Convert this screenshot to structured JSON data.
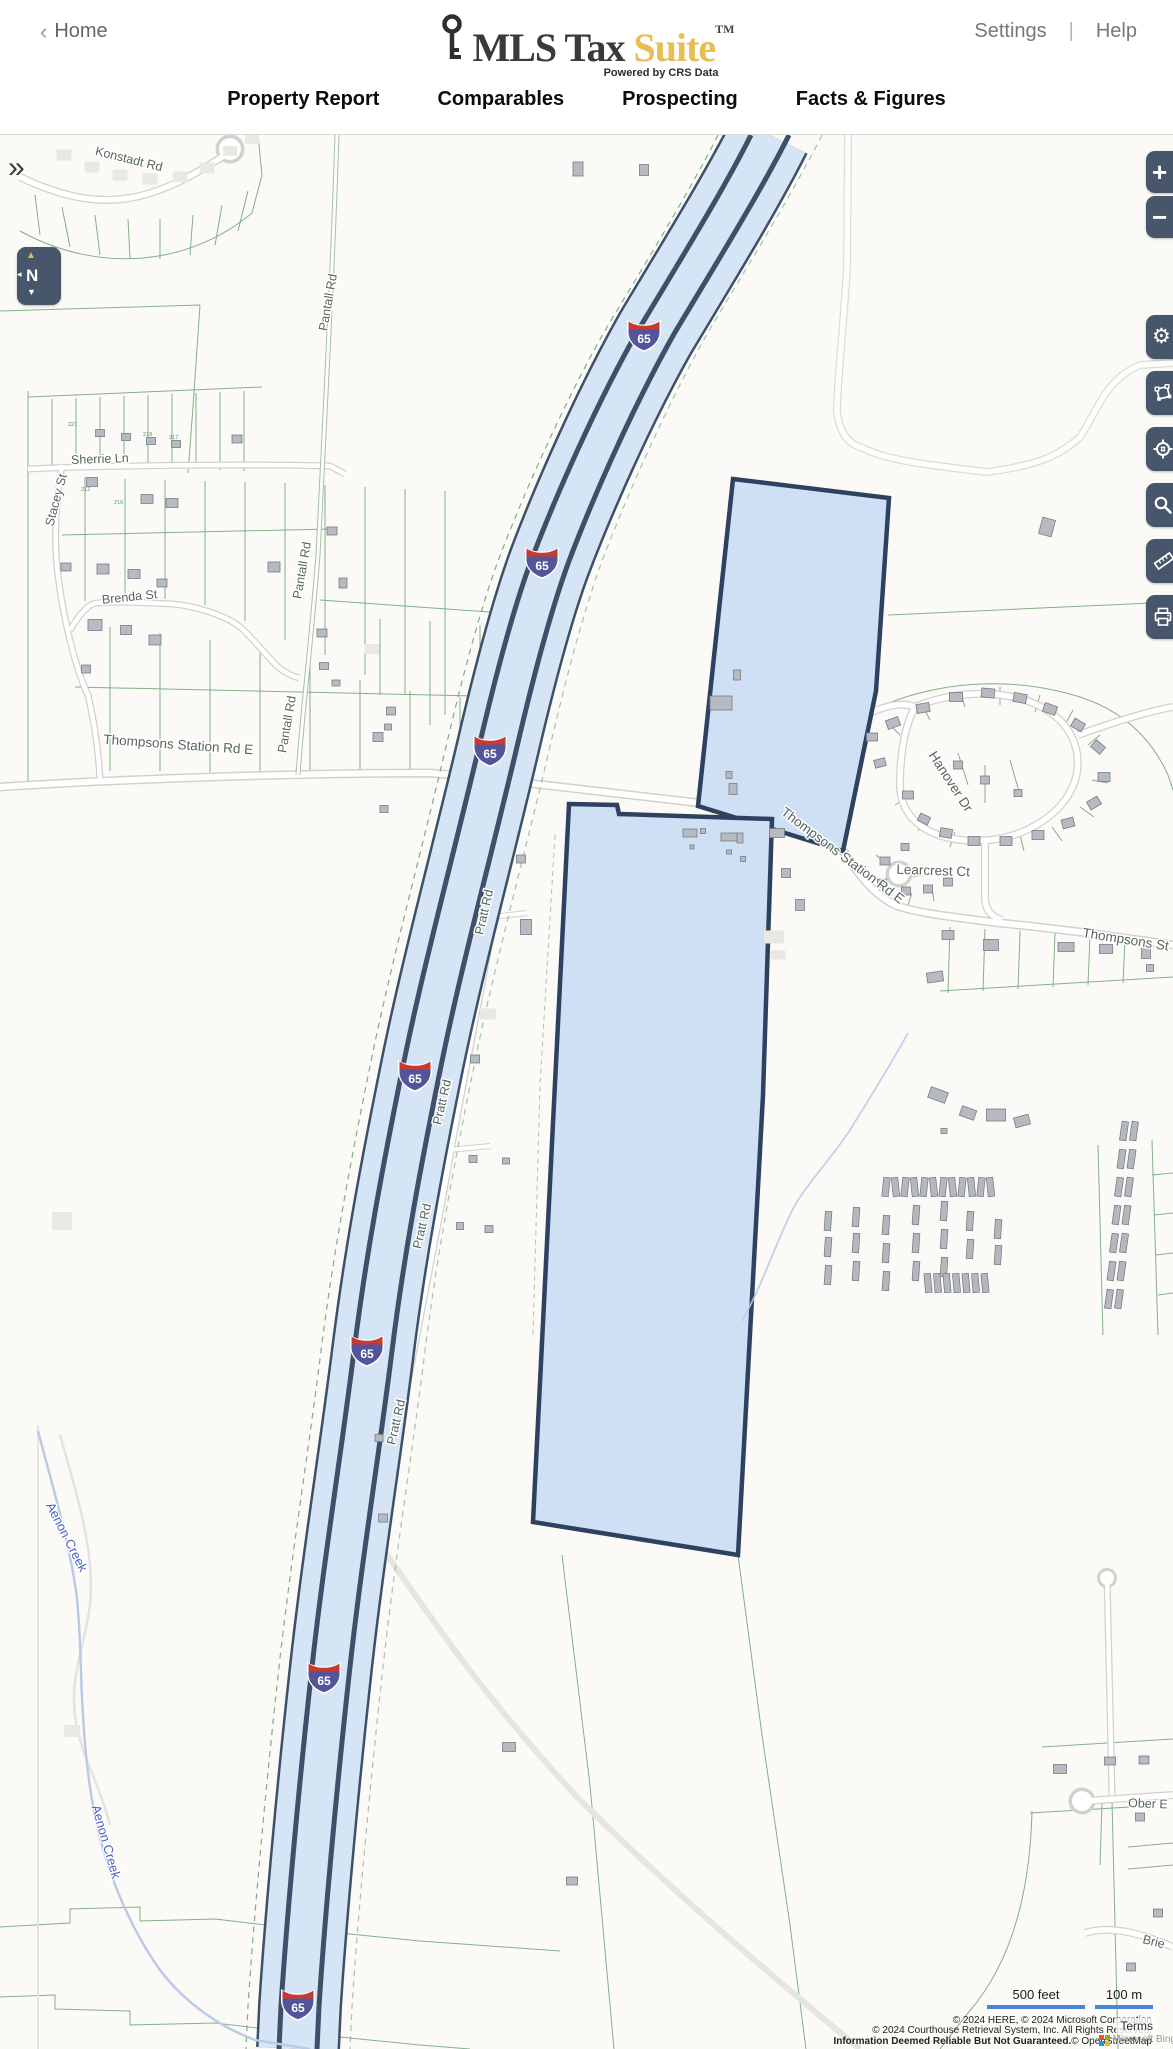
{
  "header": {
    "back_chevron": "‹",
    "home_label": "Home",
    "logo": {
      "brand": "MLS Tax",
      "brand_accent": "Suite",
      "trademark": "TM",
      "tagline": "Powered by CRS Data"
    },
    "settings_label": "Settings",
    "menu_divider": "|",
    "help_label": "Help"
  },
  "nav": {
    "tabs": [
      {
        "label": "Property Report"
      },
      {
        "label": "Comparables"
      },
      {
        "label": "Prospecting"
      },
      {
        "label": "Facts & Figures"
      }
    ]
  },
  "map": {
    "expand_sidebar_icon": "»",
    "interstate_shield": "65",
    "road_labels": {
      "konstadt": "Konstadt Rd",
      "pantall": "Pantall Rd",
      "sherrie": "Sherrie Ln",
      "stacey": "Stacey St",
      "brenda": "Brenda St",
      "thompsons_station_w": "Thompsons Station Rd E",
      "thompsons_station_e": "Thompsons Station Rd E",
      "thompsons_cut": "Thompsons St",
      "hanover": "Hanover Dr",
      "learcrest": "Learcrest Ct",
      "pratt": "Pratt Rd",
      "ober": "Ober E",
      "brier": "Brie"
    },
    "water_labels": {
      "aenon_creek": "Aenon Creek"
    },
    "parcel_numbers": [
      "221",
      "218",
      "217",
      "212",
      "216"
    ],
    "controls": [
      {
        "name": "zoom-in",
        "glyph": "+"
      },
      {
        "name": "zoom-out",
        "glyph": "−"
      },
      {
        "name": "compass",
        "glyph": "N",
        "north_arrow": "▲",
        "left_arrow": "◂",
        "down_arrow": "▼"
      },
      {
        "name": "settings",
        "glyph": "⚙"
      },
      {
        "name": "draw-polygon"
      },
      {
        "name": "locate"
      },
      {
        "name": "search"
      },
      {
        "name": "measure"
      },
      {
        "name": "print"
      }
    ],
    "scale": {
      "imperial": "500 feet",
      "metric": "100 m"
    },
    "attribution": {
      "line1": "© 2024 HERE, © 2024 Microsoft Corporation",
      "line2": "© 2024 Courthouse Retrieval System, Inc. All Rights Reserved.",
      "line3_bold": "Information Deemed Reliable But Not Guaranteed.",
      "line3_rest": "© OpenStreetMap",
      "bing_label": "Microsoft Bing",
      "terms": "Terms"
    },
    "colors": {
      "selected_parcel_fill": "#cfe0f4",
      "selected_parcel_stroke": "#2f4160",
      "highway_fill": "#d6e5f5",
      "highway_stroke": "#3e4f68",
      "parcel_line": "#74a97d",
      "control_button": "#47566b",
      "shield_red": "#c8392f",
      "shield_blue": "#54549a",
      "scale_bar": "#4a86d8",
      "brand_accent": "#e8bd52"
    }
  }
}
